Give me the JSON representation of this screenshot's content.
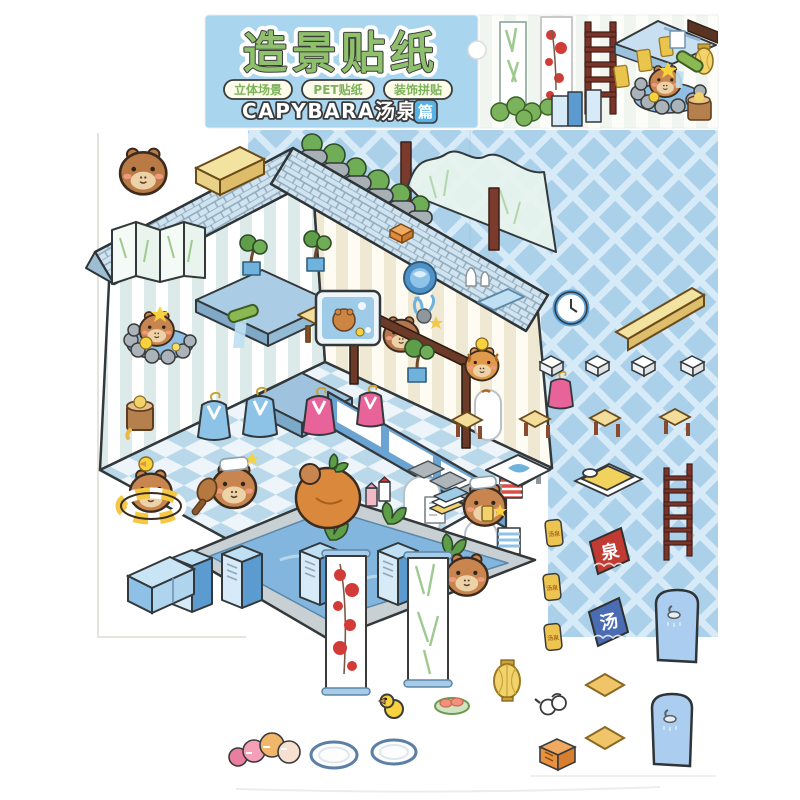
{
  "page": {
    "background": "#ffffff"
  },
  "header_card": {
    "title": "造景贴纸",
    "badges": [
      "立体场景",
      "PET贴纸",
      "装饰拼贴"
    ],
    "series": {
      "en_cn": "CAPYBARA汤泉",
      "suffix": "篇"
    },
    "colors": {
      "card_blue": "#a9d5ef",
      "title_green": "#8fc06c",
      "badge_text_green": "#7cb35a",
      "badge_bg": "#fdfbe9",
      "suffix_badge_blue": "#57b3e6"
    }
  },
  "signs": {
    "spring_sign": "泉",
    "hot_water_sign": "汤",
    "plaque_label": "汤泉"
  },
  "palette": {
    "lattice_blue": "#abd1ea",
    "lattice_line": "#d7eaf7",
    "roof_tile": "#cfe3f0",
    "wall_stripe_mint": "#dcebe9",
    "wall_stripe_cream": "#f0ead6",
    "floor_check": "#b9d8ea",
    "pool_water": "#83b6de",
    "pool_rim": "#c9d0d4",
    "locker_blue": "#5c9bd0",
    "dark_wood": "#6b3a28",
    "ladder_red": "#7c3429",
    "sign_red": "#c23b33",
    "sign_blue": "#4a6cb3",
    "gold": "#ecc44f",
    "capybara_brown": "#c9854f",
    "robe_blue": "#8ec3e8",
    "robe_pink": "#e8639a",
    "banner_plum_red": "#d23c38",
    "banner_bamboo_green": "#9ec98f",
    "bench_yellow": "#f2e3a0"
  },
  "sticker_inventory": [
    "capybara-sticker",
    "yellow-bench",
    "stone-garden-wall",
    "glass-screen",
    "folding-screen",
    "stone-bath-capybara",
    "wooden-bucket",
    "bamboo-spout",
    "blue-counter",
    "bonsai-tree",
    "bonsai-tree",
    "wall-tv-capybara",
    "counter-capybara",
    "wall-basin",
    "sake-bottles",
    "blue-mat",
    "coral-decor",
    "wall-clock",
    "long-bench",
    "towel-block",
    "towel-block",
    "towel-block",
    "towel-block",
    "wooden-stool",
    "wooden-stool",
    "wooden-stool",
    "wooden-stool",
    "blue-platform",
    "bathrobe-blue",
    "bathrobe-blue",
    "bathrobe-pink",
    "bathrobe-pink",
    "bathrobe-pink",
    "reception-window",
    "swim-ring-capybara",
    "massage-capybara",
    "tangerine-capybara",
    "drink-capybara",
    "tiger-capybara",
    "sitting-capybara",
    "milk-cartons",
    "pool-plant",
    "pool-plant",
    "locker",
    "locker",
    "locker",
    "locker",
    "plum-banner",
    "bamboo-banner",
    "futon",
    "ladder",
    "gold-plaque",
    "gold-plaque",
    "gold-plaque",
    "spring-sign",
    "hot-water-sign",
    "shower-door",
    "shower-door",
    "floor-tile",
    "floor-tile",
    "rubber-duck",
    "sushi-plate",
    "paper-lantern",
    "white-teapot",
    "macarons",
    "oval-mat",
    "oval-mat",
    "orange-crate",
    "blue-cabinet",
    "massage-bed",
    "striped-towel",
    "menu-card",
    "book-stack",
    "roof-brick"
  ]
}
